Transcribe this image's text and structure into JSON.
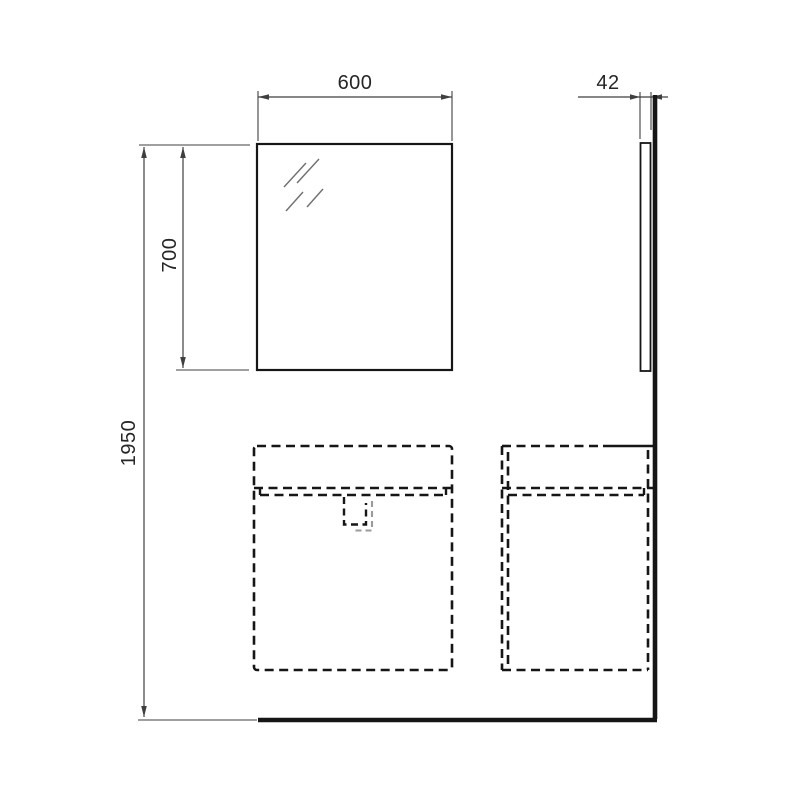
{
  "drawing": {
    "type": "technical-installation-drawing",
    "views": {
      "front": [
        "mirror",
        "left-vanity-cabinet-dashed",
        "right-vanity-cabinet-dashed"
      ],
      "side": [
        "mirror-profile-panel",
        "wall-line",
        "floor-line"
      ]
    }
  },
  "dimensions": {
    "mirror_width": "600",
    "mirror_height": "700",
    "total_height": "1950",
    "side_depth": "42"
  },
  "colors": {
    "background": "#ffffff",
    "outline": "#161616",
    "dimension": "#3f3f3f",
    "hatch": "#6f6f6f",
    "shadow": "#9a9a9a",
    "text": "#262626"
  }
}
